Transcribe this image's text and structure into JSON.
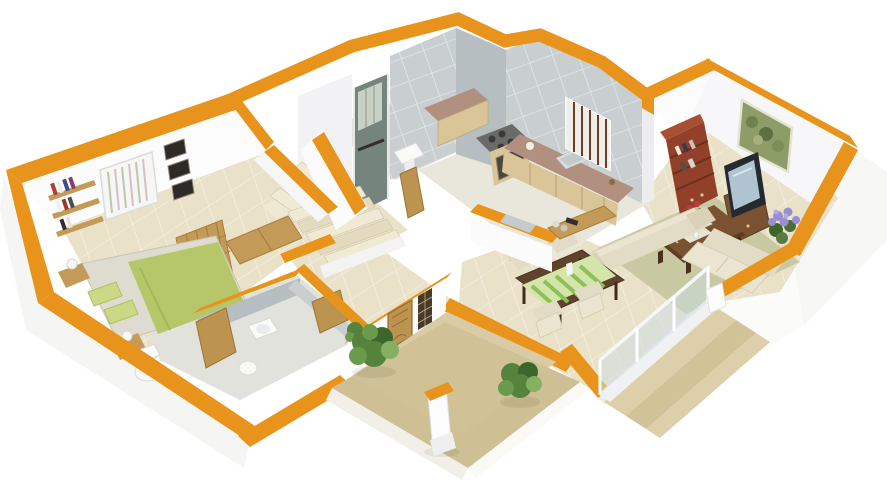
{
  "meta": {
    "description": "3D isometric cutaway floor-plan render of a one-storey house",
    "canvas": {
      "width": 887,
      "height": 500
    }
  },
  "colors": {
    "orange": "#E8941C",
    "orange_dark": "#C2770E",
    "wall_white": "#FCFCFD",
    "wall_shade": "#F0F0F3",
    "tile_gray": "#C9CFD1",
    "tile_gray_dark": "#B7BEC1",
    "floor_beige": "#EAE1C9",
    "floor_gray": "#E2E2DC",
    "kitchen_floor": "#E9E7DB",
    "porch_tile": "#D9CCA4",
    "porch_tile_dark": "#CEC095",
    "step_beige": "#DCCFA9",
    "step_dark": "#D1C298",
    "bed_green": "#B5C769",
    "pillow_green": "#CBD985",
    "mattress": "#DEDCD0",
    "wood": "#C49A58",
    "door_wood": "#BD9350",
    "granite": "#B2907F",
    "cabinet": "#D9C597",
    "sofa": "#EAE4D1",
    "sofa_dark": "#D9D2B9",
    "rug": "#C8C8A2",
    "table_dark": "#5F432C",
    "coffee_table": "#7A5232",
    "shelf_red": "#93402B",
    "tv_dark": "#242A30",
    "tv_screen": "#AFC4D0",
    "plant": "#55833D",
    "plant_dark": "#3C672B",
    "plant_light": "#86B061",
    "flower_purple": "#998FD0",
    "flower_red": "#C23A3A",
    "glass": "#CADEE6",
    "art_green": "#8E9C68",
    "shower_glass": "#75847C"
  },
  "scene": {
    "rooms": [
      "bedroom",
      "ensuite-bathroom",
      "hallway",
      "staircase",
      "shower-room",
      "kitchen",
      "dining-area",
      "living-room",
      "entrance-porch"
    ],
    "objects": [
      "double-bed",
      "pillows",
      "headboard",
      "nightstands",
      "table-lamps",
      "wall-shelves",
      "books",
      "barred-window",
      "picture-frames",
      "wardrobe",
      "toilet",
      "washbasin",
      "bidet",
      "wooden-doors",
      "stair-treads",
      "shower-enclosure",
      "kitchen-counter",
      "gas-stove",
      "oven",
      "kitchen-sink",
      "breakfast-bar",
      "dining-table",
      "table-runner",
      "dining-chairs",
      "sofa",
      "coffee-table",
      "flower-vase",
      "tv-set",
      "tv-cabinet",
      "bookshelf",
      "wall-art",
      "purple-plant",
      "potted-shrubs",
      "porch-pillar",
      "front-door",
      "glass-railing",
      "outdoor-steps"
    ]
  }
}
